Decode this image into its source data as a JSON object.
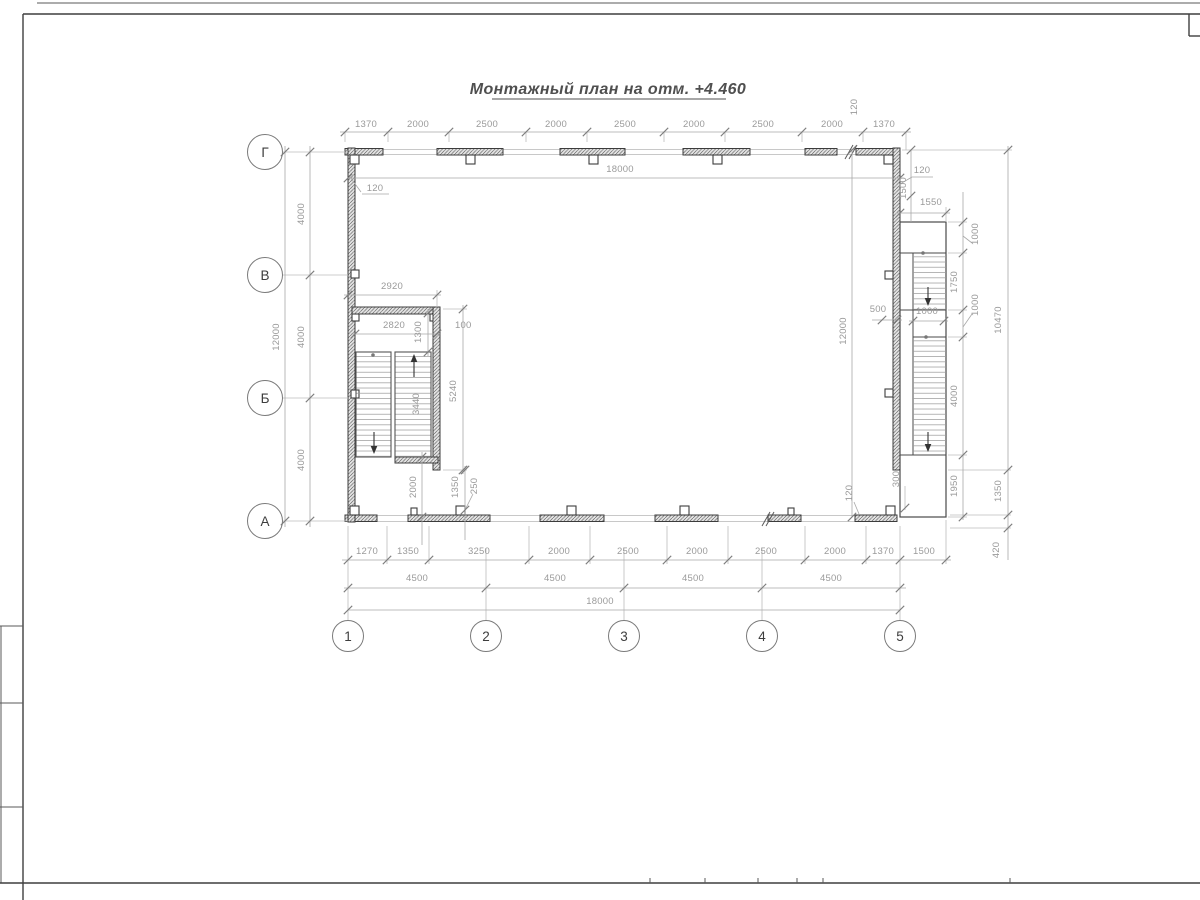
{
  "sheet": {
    "title": "Монтажный план на отм. +4.460"
  },
  "axes": {
    "rows": [
      {
        "label": "Г"
      },
      {
        "label": "В"
      },
      {
        "label": "Б"
      },
      {
        "label": "А"
      }
    ],
    "cols": [
      {
        "label": "1"
      },
      {
        "label": "2"
      },
      {
        "label": "3"
      },
      {
        "label": "4"
      },
      {
        "label": "5"
      }
    ]
  },
  "dims": {
    "top_chain": [
      "1370",
      "2000",
      "2500",
      "2000",
      "2500",
      "2000",
      "2500",
      "2000",
      "1370"
    ],
    "top_offset": "120",
    "inner_width": "18000",
    "wall_thickness": "120",
    "left_chain": [
      "4000",
      "4000",
      "4000"
    ],
    "left_total": "12000",
    "bottom_chain": [
      "1270",
      "1350",
      "3250",
      "2000",
      "2500",
      "2000",
      "2500",
      "2000",
      "1370",
      "1500"
    ],
    "bottom_bays": [
      "4500",
      "4500",
      "4500",
      "4500"
    ],
    "bottom_total": "18000",
    "stair": {
      "width_outer": "2920",
      "width_inner": "2820",
      "landing": "1300",
      "gap": "100",
      "well": "5240",
      "flight": "3440",
      "below": "2000",
      "b_off": "1350",
      "b_small": "250"
    },
    "right": {
      "wall": "120",
      "top1500": "1500",
      "top1550": "1550",
      "lead_a": "1000",
      "run1": "1750",
      "lead_b": "1000",
      "mid500": "500",
      "mid1000": "1000",
      "height": "12000",
      "total": "10470",
      "run2": "4000",
      "bottom1950": "1950",
      "off1350": "1350",
      "off420": "420",
      "off300": "300",
      "wall_b": "120"
    }
  }
}
